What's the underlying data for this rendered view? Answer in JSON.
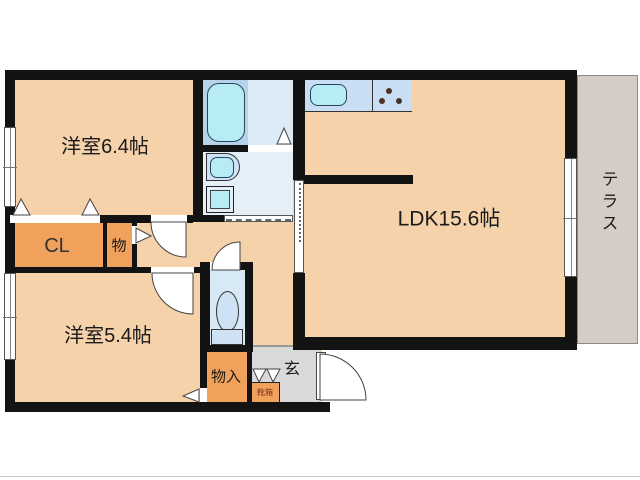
{
  "title": "2LDK apartment floor plan",
  "rooms": {
    "bedroom1": "洋室6.4帖",
    "bedroom2": "洋室5.4帖",
    "ldk": "LDK15.6帖",
    "closet": "CL",
    "storage": "物",
    "storage2": "物入",
    "entrance": "玄",
    "shoebox": "靴箱",
    "terrace": "テラス"
  },
  "colors": {
    "wall": "#131313",
    "floor": "#f5d2a9",
    "closet": "#f0a25c",
    "bath": "#dcebf6",
    "washroom": "#e4eff8",
    "toilet_room": "#d8e9f6",
    "counter": "#c9def2",
    "fixture": "#b7ecf5",
    "fixture_light": "#cfe1f4",
    "tub_panel": "#b8d2e9",
    "genkan": "#d9d9d9",
    "terrace": "#d5cdc5",
    "label": "#1a1a1a",
    "shoebox_label": "#7b3222",
    "stove_dot": "#4a342a"
  }
}
